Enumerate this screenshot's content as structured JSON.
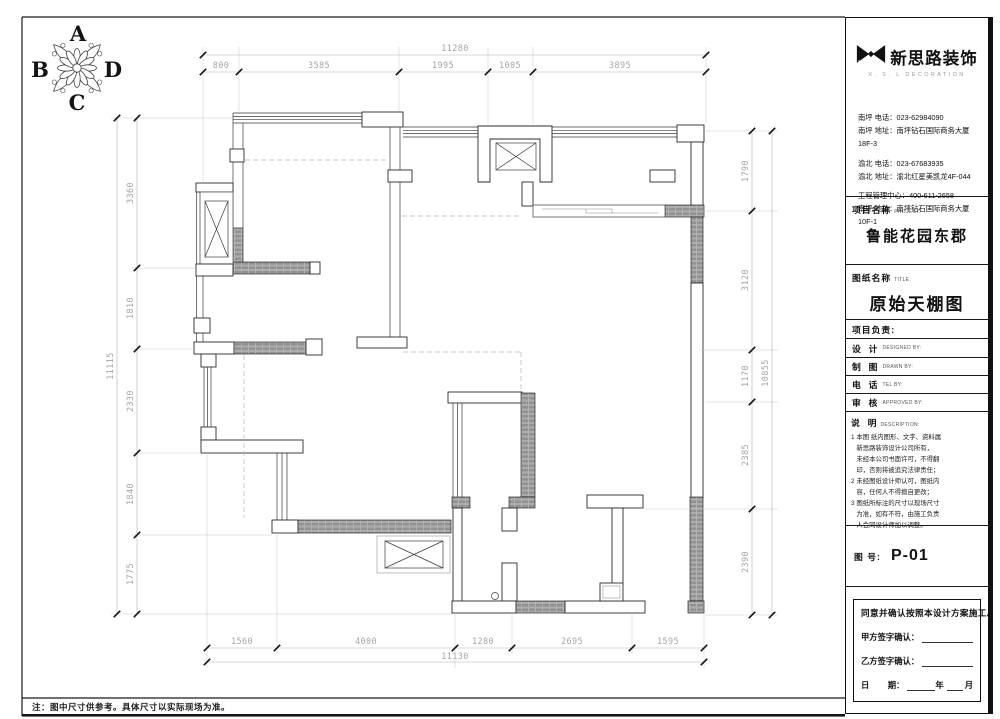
{
  "compass": {
    "top": "A",
    "left": "B",
    "bottom": "C",
    "right": "D"
  },
  "footer_note": "注：图中尺寸供参考。具体尺寸以实际现场为准。",
  "dims": {
    "top": {
      "total": "11280",
      "segments": [
        "800",
        "3585",
        "1995",
        "1005",
        "3895"
      ]
    },
    "bottom": {
      "total": "11130",
      "segments": [
        "1560",
        "4000",
        "1280",
        "2695",
        "1595"
      ]
    },
    "left": {
      "total": "11115",
      "segments": [
        "3360",
        "1810",
        "2330",
        "1840",
        "1775"
      ]
    },
    "right": {
      "total": "10855",
      "segments": [
        "1790",
        "3120",
        "1170",
        "2385",
        "2390"
      ]
    }
  },
  "brand": {
    "name": "新思路装饰",
    "tagline": "X. S. L  DECORATION",
    "mark": "X.S.L"
  },
  "contacts": [
    "南坪  电话：023-62984090",
    "南坪  地址：南坪钻石国际商务大厦18F-3",
    "渝北  电话：023-67683935",
    "渝北  地址：渝北红星美凯龙4F-044",
    "工程管理中心：400-611-2658",
    "南坪  地址：南坪钻石国际商务大厦10F-1"
  ],
  "project": {
    "label": "项目名称",
    "label_en": "PROJECT:",
    "value": "鲁能花园东郡"
  },
  "drawing": {
    "label": "图纸名称",
    "label_en": "TITLE:",
    "value": "原始天棚图"
  },
  "lead": {
    "label": "项目负责:"
  },
  "fields": [
    {
      "label": "设  计",
      "en": "DESIGNED BY:"
    },
    {
      "label": "制  图",
      "en": "DRAWN BY:"
    },
    {
      "label": "电  话",
      "en": "TEL BY:"
    },
    {
      "label": "审  核",
      "en": "APPROVED BY:"
    }
  ],
  "description": {
    "label": "说  明",
    "en": "DESCRIPTION:",
    "notes": [
      "1 本图 纸内图形、文字、资料属",
      "   新思路装饰设计公司所有，",
      "   未经本公司书面许可，不得翻",
      "   印，否则将被追究法律责任；",
      "2 未经图纸设计师认可，图纸内",
      "   容，任何人不得擅自更改；",
      "3 图纸所标注的尺寸以现场尺寸",
      "   为准，如有不符，由施工负责",
      "   人会同设计师加以调整。"
    ]
  },
  "sheet_no": {
    "label": "图 号:",
    "value": "P-01"
  },
  "signoff": {
    "statement": "同意并确认按照本设计方案施工。",
    "party_a": "甲方签字确认：",
    "party_b": "乙方签字确认：",
    "date_label": "日        期：",
    "year": "年",
    "month": "月"
  }
}
